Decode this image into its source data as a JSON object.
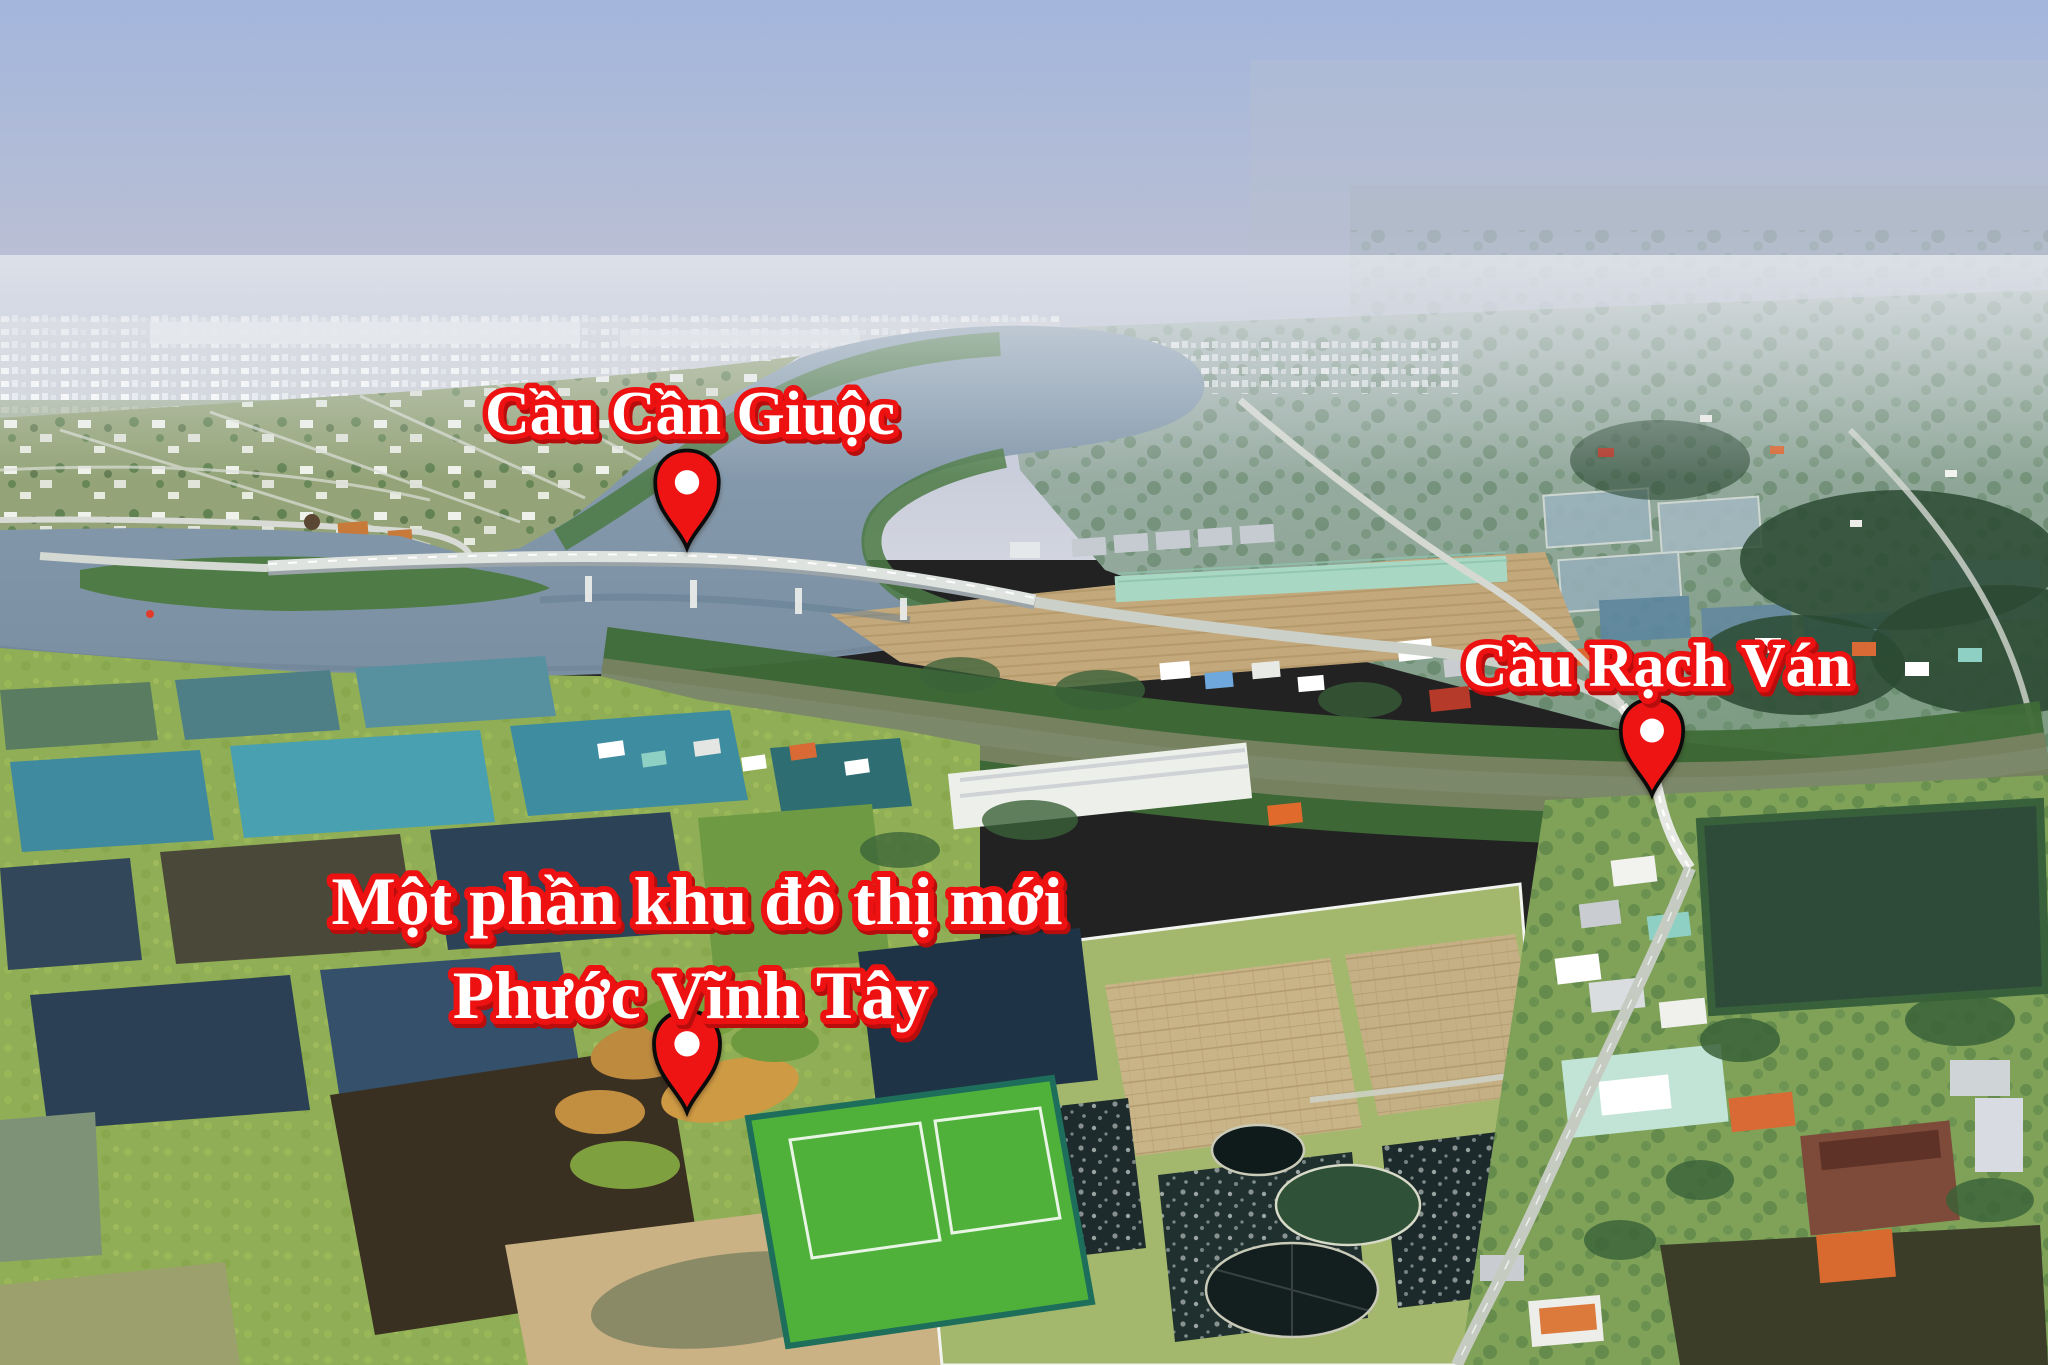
{
  "labels": {
    "bridge1": "Cầu Cần Giuộc",
    "bridge2": "Cầu Rạch Ván",
    "urban_area_line1": "Một phần  khu đô thị mới",
    "urban_area_line2": "Phước Vĩnh Tây"
  },
  "label_style": {
    "fill": "#FFFFFF",
    "stroke": "#EE1111",
    "shadow": "#B80D0D"
  },
  "pin_style": {
    "fill": "#EE1414",
    "outline": "#0B0B0B",
    "hole": "#FFFFFF"
  },
  "palette": {
    "sky_top": "#A3B6DC",
    "sky_horizon": "#D2D5DF",
    "distant_city": "#CFD3D8",
    "river": "#8098AB",
    "creek": "#75815F",
    "mangrove": "#3F6B37",
    "fields_grass": "#8FAE55",
    "sand_development": "#C3A87C",
    "pond_teal": "#49A0B0",
    "pond_navy": "#2C4257",
    "pond_dark_aerator": "#1E2B2C",
    "raft_tan": "#C9B488",
    "sports_field_green": "#4FB13A",
    "road": "#CBD0C8"
  }
}
